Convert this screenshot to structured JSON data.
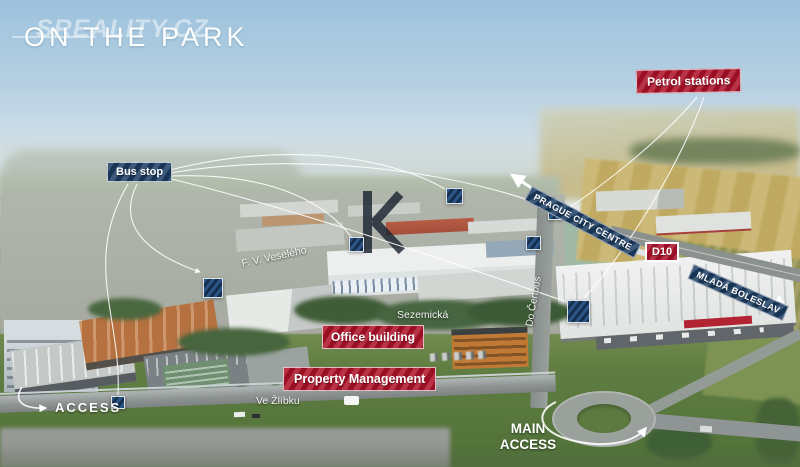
{
  "watermark": "SREALITY.CZ",
  "title": "ON THE PARK",
  "overlay_labels": {
    "bus_stop": {
      "text": "Bus stop",
      "color": "#1d3e63"
    },
    "petrol_stations": {
      "text": "Petrol stations",
      "color": "#ac1128"
    },
    "prague_city_centre": {
      "text": "PRAGUE CITY CENTRE",
      "color": "#1d3e63"
    },
    "d10": {
      "text": "D10",
      "color": "#ac1128"
    },
    "mlada_boleslav": {
      "text": "MLADÁ BOLESLAV",
      "color": "#1d3e63"
    },
    "office_building": {
      "text": "Office building",
      "color": "#ac1128"
    },
    "property_management": {
      "text": "Property Management",
      "color": "#ac1128"
    },
    "access": {
      "text": "ACCESS"
    },
    "main_access": {
      "text": "MAIN\nACCESS"
    }
  },
  "street_names": {
    "f_v_veseleho": "F. V. Veselého",
    "sezemicka": "Sezemická",
    "ve_zlibku": "Ve Žlíbku",
    "do_certous": "Do Čertous"
  },
  "icons": {
    "location_marker": "striped-navy-square",
    "arrow": "white-arrow"
  },
  "colors": {
    "label_red": "#ac1128",
    "label_navy": "#1d3e63",
    "marker_navy": "#1d416e",
    "overlay_text": "#ffffff"
  }
}
